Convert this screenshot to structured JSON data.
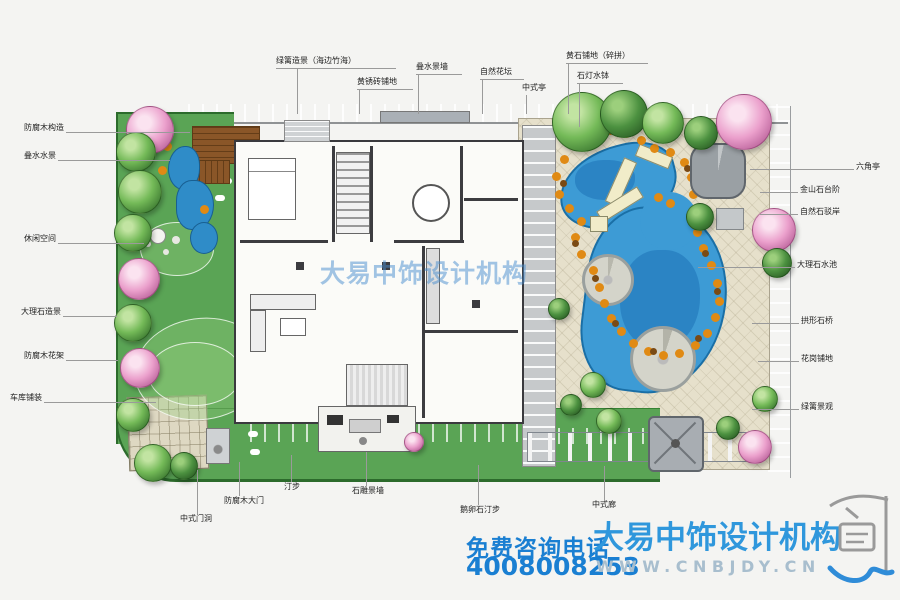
{
  "plan": {
    "type": "residential landscape design plan (top view)",
    "watermark_center": "大易中饰设计机构"
  },
  "labels": {
    "top": [
      {
        "t": "绿篱造景（海边竹海）"
      },
      {
        "t": "黄锈砖铺地"
      },
      {
        "t": "叠水景墙"
      },
      {
        "t": "自然花坛"
      },
      {
        "t": "中式亭"
      },
      {
        "t": "黄石铺地（碎拼）"
      },
      {
        "t": "石灯水钵"
      }
    ],
    "left": [
      {
        "t": "防腐木构造"
      },
      {
        "t": "叠水水景"
      },
      {
        "t": "休闲空间"
      },
      {
        "t": "大理石造景"
      },
      {
        "t": "防腐木花架"
      },
      {
        "t": "车库铺装"
      }
    ],
    "right": [
      {
        "t": "六角亭"
      },
      {
        "t": "金山石台阶"
      },
      {
        "t": "自然石驳岸"
      },
      {
        "t": "大理石水池"
      },
      {
        "t": "拱形石桥"
      },
      {
        "t": "花岗铺地"
      },
      {
        "t": "绿篱景观"
      }
    ],
    "bottom": [
      {
        "t": "中式门洞"
      },
      {
        "t": "防腐木大门"
      },
      {
        "t": "汀步"
      },
      {
        "t": "石雕景墙"
      },
      {
        "t": "鹅卵石汀步"
      },
      {
        "t": "中式廊"
      }
    ]
  },
  "footer": {
    "phone_label": "免费咨询电话",
    "phone": "4008008253",
    "brand": "大易中饰设计机构",
    "website": "WWW.CNBJDY.CN"
  },
  "colors": {
    "lawn": "#5aa455",
    "pond": "#3d9bd5",
    "paving": "#e6e0cb",
    "rock_orange": "#e08a14",
    "road_gray": "#cdd0d2",
    "footer_blue": "#1a7fd2",
    "brand_blue": "#2f97dc"
  },
  "icons": {
    "logo": "dayi-seal-logo",
    "logo_swoosh": "blue-swoosh"
  }
}
